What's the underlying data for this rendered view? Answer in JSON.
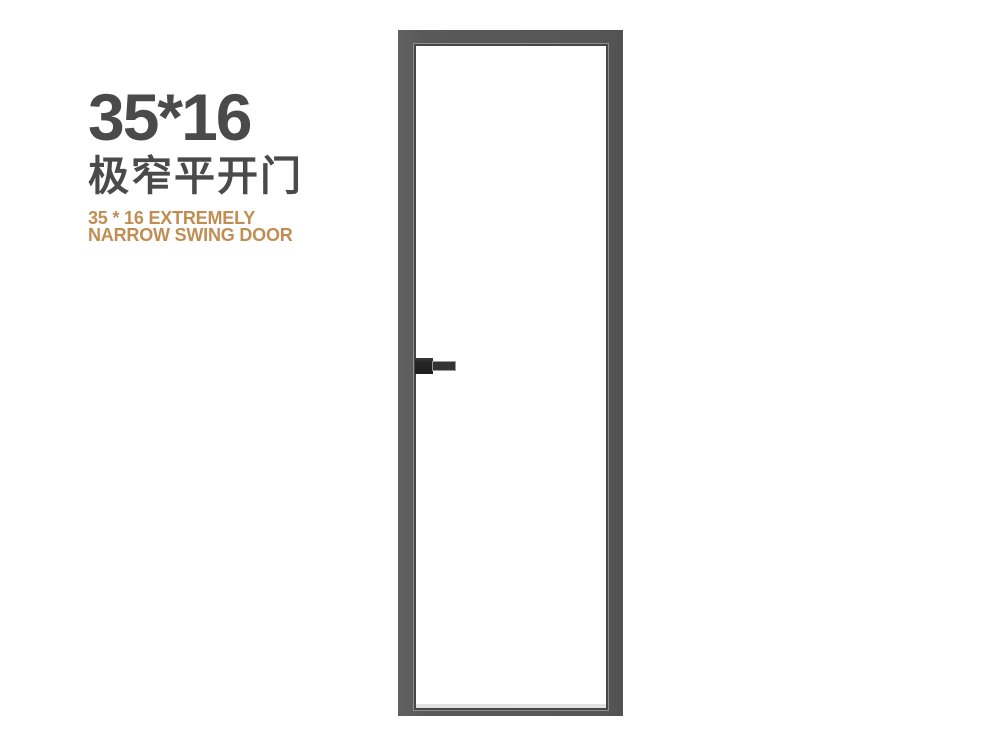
{
  "page": {
    "background_color": "#ffffff"
  },
  "headline": {
    "size_label": "35*16",
    "product_name_zh": "极窄平开门",
    "subtitle_en_line1": "35 * 16 EXTREMELY",
    "subtitle_en_line2": "NARROW SWING DOOR",
    "text_color": "#4a4a4b",
    "accent_color": "#c08e52"
  },
  "door": {
    "frame_color": "#595959",
    "leaf_color": "#ffffff",
    "seam_color": "#474747",
    "highlight_color": "#8f8f8f",
    "sill_shadow_color": "#e2e2e2",
    "handle_base_color": "#242424",
    "handle_lever_color": "#333333"
  }
}
